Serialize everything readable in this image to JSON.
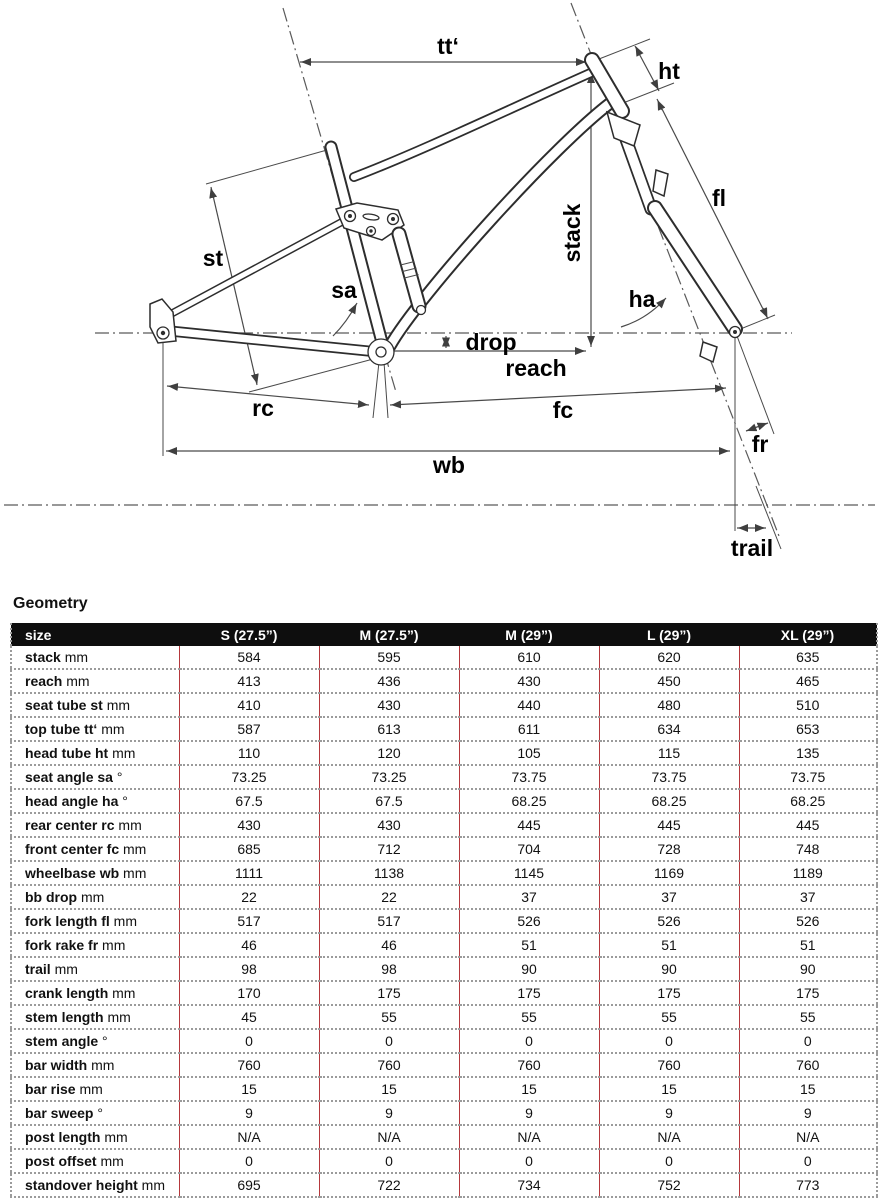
{
  "diagram": {
    "labels": {
      "top_tube": "tt‘",
      "head_tube": "ht",
      "fork_length": "fl",
      "stack": "stack",
      "seat_tube": "st",
      "seat_angle": "sa",
      "head_angle": "ha",
      "drop": "drop",
      "reach": "reach",
      "rear_center": "rc",
      "front_center": "fc",
      "wheelbase": "wb",
      "fork_rake": "fr",
      "trail": "trail"
    }
  },
  "section_title": "Geometry",
  "table": {
    "colors": {
      "divider_red": "#b5383c",
      "header_bg": "#0e0e0e"
    },
    "header": [
      "size",
      "S (27.5”)",
      "M (27.5”)",
      "M (29”)",
      "L (29”)",
      "XL (29”)"
    ],
    "rows": [
      {
        "label": "stack",
        "unit": "mm",
        "values": [
          "584",
          "595",
          "610",
          "620",
          "635"
        ]
      },
      {
        "label": "reach",
        "unit": "mm",
        "values": [
          "413",
          "436",
          "430",
          "450",
          "465"
        ]
      },
      {
        "label": "seat tube st",
        "unit": "mm",
        "values": [
          "410",
          "430",
          "440",
          "480",
          "510"
        ]
      },
      {
        "label": "top tube tt‘",
        "unit": "mm",
        "values": [
          "587",
          "613",
          "611",
          "634",
          "653"
        ]
      },
      {
        "label": "head tube ht",
        "unit": "mm",
        "values": [
          "110",
          "120",
          "105",
          "115",
          "135"
        ]
      },
      {
        "label": "seat angle sa",
        "unit": "°",
        "values": [
          "73.25",
          "73.25",
          "73.75",
          "73.75",
          "73.75"
        ]
      },
      {
        "label": "head angle ha",
        "unit": "°",
        "values": [
          "67.5",
          "67.5",
          "68.25",
          "68.25",
          "68.25"
        ]
      },
      {
        "label": "rear center rc",
        "unit": "mm",
        "values": [
          "430",
          "430",
          "445",
          "445",
          "445"
        ]
      },
      {
        "label": "front center fc",
        "unit": "mm",
        "values": [
          "685",
          "712",
          "704",
          "728",
          "748"
        ]
      },
      {
        "label": "wheelbase wb",
        "unit": "mm",
        "values": [
          "1111",
          "1138",
          "1145",
          "1169",
          "1189"
        ]
      },
      {
        "label": "bb drop",
        "unit": "mm",
        "values": [
          "22",
          "22",
          "37",
          "37",
          "37"
        ]
      },
      {
        "label": "fork length fl",
        "unit": "mm",
        "values": [
          "517",
          "517",
          "526",
          "526",
          "526"
        ]
      },
      {
        "label": "fork rake fr",
        "unit": "mm",
        "values": [
          "46",
          "46",
          "51",
          "51",
          "51"
        ]
      },
      {
        "label": "trail",
        "unit": "mm",
        "values": [
          "98",
          "98",
          "90",
          "90",
          "90"
        ]
      },
      {
        "label": "crank length",
        "unit": "mm",
        "values": [
          "170",
          "175",
          "175",
          "175",
          "175"
        ]
      },
      {
        "label": "stem length",
        "unit": "mm",
        "values": [
          "45",
          "55",
          "55",
          "55",
          "55"
        ]
      },
      {
        "label": "stem angle",
        "unit": "°",
        "values": [
          "0",
          "0",
          "0",
          "0",
          "0"
        ]
      },
      {
        "label": "bar width",
        "unit": "mm",
        "values": [
          "760",
          "760",
          "760",
          "760",
          "760"
        ]
      },
      {
        "label": "bar rise",
        "unit": "mm",
        "values": [
          "15",
          "15",
          "15",
          "15",
          "15"
        ]
      },
      {
        "label": "bar sweep",
        "unit": "°",
        "values": [
          "9",
          "9",
          "9",
          "9",
          "9"
        ]
      },
      {
        "label": "post length",
        "unit": "mm",
        "values": [
          "N/A",
          "N/A",
          "N/A",
          "N/A",
          "N/A"
        ]
      },
      {
        "label": "post offset",
        "unit": "mm",
        "values": [
          "0",
          "0",
          "0",
          "0",
          "0"
        ]
      },
      {
        "label": "standover height",
        "unit": "mm",
        "values": [
          "695",
          "722",
          "734",
          "752",
          "773"
        ]
      }
    ]
  }
}
